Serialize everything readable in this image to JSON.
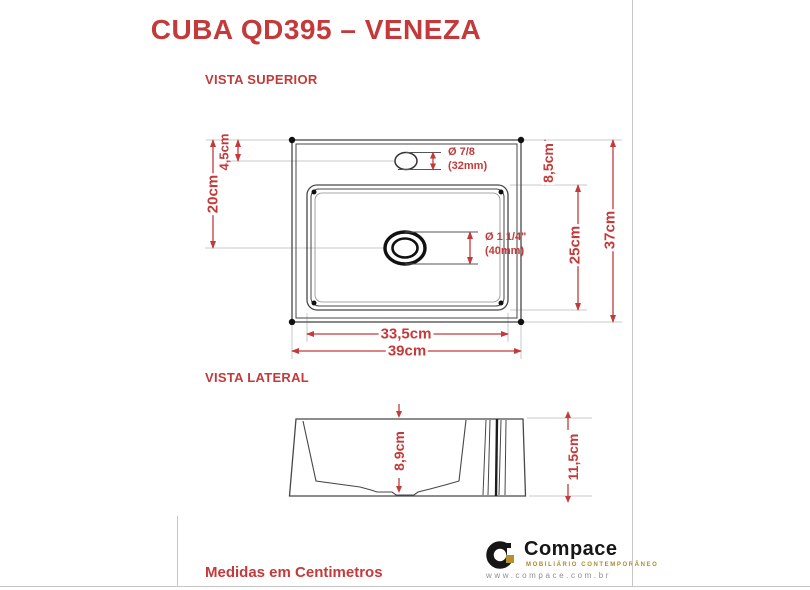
{
  "title": "CUBA QD395 – VENEZA",
  "views": {
    "superior_label": "VISTA SUPERIOR",
    "lateral_label": "VISTA LATERAL"
  },
  "top_view": {
    "faucet_offset": "4,5cm",
    "drain_offset": "20cm",
    "basin_back_offset": "8,5cm",
    "basin_length": "25cm",
    "total_depth": "37cm",
    "basin_width": "33,5cm",
    "total_width": "39cm",
    "faucet_hole_diameter": "Ø 7/8",
    "faucet_hole_mm": "(32mm)",
    "drain_diameter": "Ø 1 1/4\"",
    "drain_mm": "(40mm)"
  },
  "side_view": {
    "inner_depth": "8,9cm",
    "total_height": "11,5cm"
  },
  "footer": {
    "note": "Medidas em Centimetros"
  },
  "logo": {
    "brand": "Compace",
    "tagline": "MOBILIÁRIO CONTEMPORÂNEO",
    "website": "www.compace.com.br"
  },
  "colors": {
    "accent_red": "#C43A3A",
    "drawing_line": "#474747",
    "extension_line": "#c9c9c9",
    "logo_black": "#161616",
    "logo_gold": "#AD8A2E",
    "website_gray": "#8f8f8f"
  }
}
